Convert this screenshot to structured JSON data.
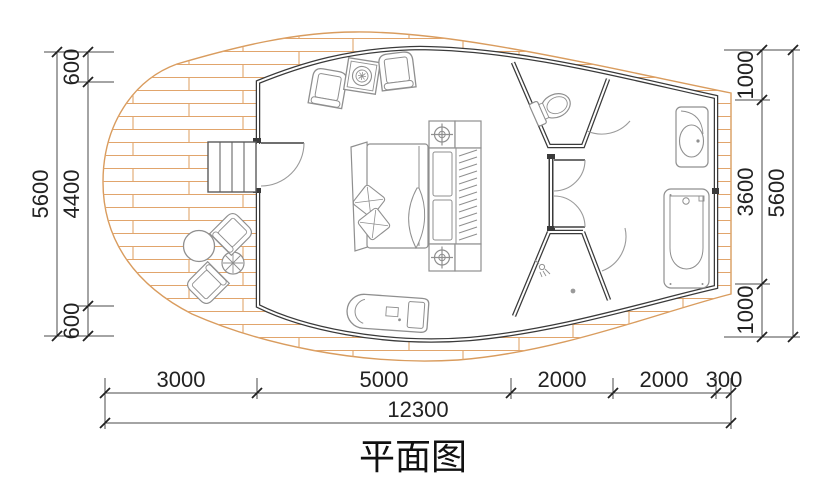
{
  "title": "平面图",
  "drawing": {
    "type": "floor-plan",
    "dimensions_mm": {
      "left": {
        "segments": [
          "600",
          "4400",
          "600"
        ],
        "total": "5600"
      },
      "right": {
        "segments": [
          "1000",
          "3600",
          "1000"
        ],
        "total": "5600"
      },
      "bottom": {
        "segments": [
          "3000",
          "5000",
          "2000",
          "2000",
          "300"
        ],
        "total": "12300"
      }
    },
    "colors": {
      "wall": "#3a3a3a",
      "deck_line": "#dca469",
      "furniture_line": "#8f8f8f",
      "dimension_line": "#4a4a4a",
      "text": "#222222",
      "background": "#ffffff"
    },
    "rooms": [
      "main-room",
      "wc",
      "shower-room",
      "bathroom",
      "deck"
    ],
    "furniture": [
      "armchair-left",
      "side-table",
      "armchair-right",
      "bed",
      "pillows",
      "wardrobe",
      "downlight-top",
      "downlight-bottom",
      "chaise-lounge",
      "entry-stairs",
      "outdoor-round-table",
      "outdoor-side-table",
      "outdoor-chair-top",
      "outdoor-chair-bottom",
      "toilet",
      "washbasin",
      "bathtub",
      "shower-head",
      "floor-drain"
    ]
  }
}
